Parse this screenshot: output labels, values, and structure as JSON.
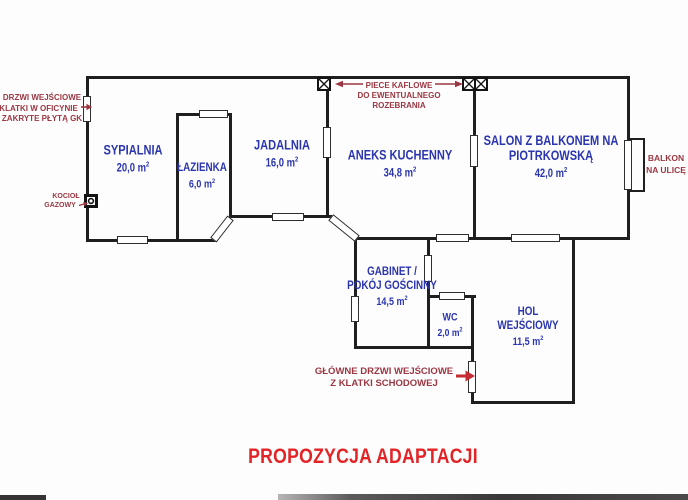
{
  "title": "PROPOZYCJA ADAPTACJI",
  "rooms": {
    "sypialnia": {
      "name": "SYPIALNIA",
      "area": "20,0 m",
      "area_sup": "2"
    },
    "lazienka": {
      "name": "ŁAZIENKA",
      "area": "6,0 m",
      "area_sup": "2"
    },
    "jadalnia": {
      "name": "JADALNIA",
      "area": "16,0 m",
      "area_sup": "2"
    },
    "aneks": {
      "name": "ANEKS KUCHENNY",
      "area": "34,8 m",
      "area_sup": "2"
    },
    "salon": {
      "name_line1": "SALON Z BALKONEM NA",
      "name_line2": "PIOTRKOWSKĄ",
      "area": "42,0 m",
      "area_sup": "2"
    },
    "gabinet": {
      "name_line1": "GABINET /",
      "name_line2": "POKÓJ GOŚCINNY",
      "area": "14,5 m",
      "area_sup": "2"
    },
    "wc": {
      "name": "WC",
      "area": "2,0 m",
      "area_sup": "2"
    },
    "hol": {
      "name_line1": "HOL",
      "name_line2": "WEJŚCIOWY",
      "area": "11,5 m",
      "area_sup": "2"
    }
  },
  "annotations": {
    "covered_door": {
      "line1": "DRZWI WEJŚCIOWE",
      "line2": "Z KLATKI W OFICYNIE",
      "line3": "ZAKRYTE PŁYTĄ GK"
    },
    "boiler": {
      "line1": "KOCIOŁ",
      "line2": "GAZOWY"
    },
    "stoves": {
      "line1": "PIECE KAFLOWE",
      "line2": "DO EWENTUALNEGO",
      "line3": "ROZEBRANIA"
    },
    "balcony": {
      "line1": "BALKON",
      "line2": "NA ULICĘ"
    },
    "main_door": {
      "line1": "GŁÓWNE DRZWI WEJŚCIOWE",
      "line2": "Z KLATKI SCHODOWEJ"
    }
  },
  "colors": {
    "wall": "#1f1f1f",
    "label": "#2a35ae",
    "annotation": "#9b3742",
    "arrow": "#c62b31",
    "title": "#e22427"
  }
}
